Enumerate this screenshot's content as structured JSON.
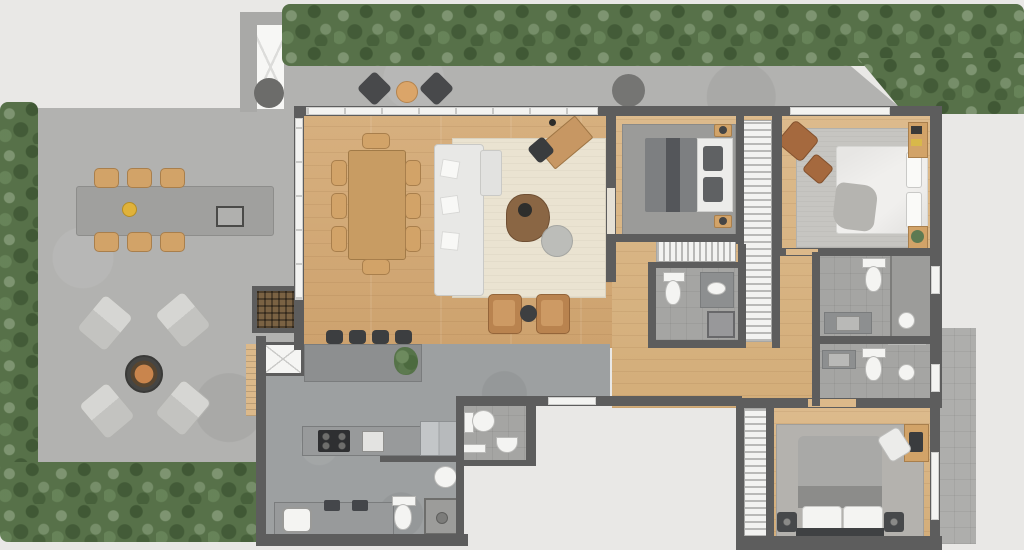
{
  "title": "apartment-floor-plan",
  "view": "top-down-render",
  "palette": {
    "background": "#e9e8e6",
    "walls": "#5d5d5d",
    "wood_floor": "#d3ab79",
    "concrete_floor": "#9da0a1",
    "terrace_concrete": "#b2b2b0",
    "hedge_green": "#577149",
    "rug_cream": "#eae3d1",
    "fixture_white": "#f4f4f2",
    "furniture_wood": "#c89c63",
    "dark_stool": "#3c3e40",
    "leather_brown": "#a5693e",
    "fire_accent": "#c9854d"
  },
  "outdoor": {
    "hedges": [
      "top-band",
      "top-right-block",
      "left-band",
      "bottom-left-band"
    ],
    "walkway": {
      "stools": 2,
      "round_side_table": 1,
      "planter_box_with_tree": 1,
      "round_planter": 1
    },
    "terrace": {
      "outdoor_dining_table": 1,
      "dining_chairs": 6,
      "grill": 1,
      "serving_bowl": 1,
      "fire_pit": 1,
      "lounge_chairs": 4,
      "green_wall_trellis": 1
    },
    "side_patio": 1
  },
  "rooms": [
    {
      "name": "living-dining",
      "floor": "wood",
      "items": [
        "dining-table",
        "dining-chairs-8",
        "l-shaped-sofa",
        "throw-pillows",
        "cream-rug",
        "organic-coffee-table",
        "pouf",
        "armchairs-2",
        "round-side-table",
        "angled-desk",
        "desk-chair",
        "floor-lamp",
        "sliding-glass-walls"
      ]
    },
    {
      "name": "kitchen",
      "floor": "concrete",
      "items": [
        "bar-counter",
        "bar-stools-4",
        "plant",
        "island-counter",
        "cooktop",
        "oven",
        "refrigerator",
        "lower-counter",
        "washer",
        "sinks-2",
        "elevator-shaft",
        "entry-step"
      ]
    },
    {
      "name": "powder-room",
      "floor": "tile",
      "items": [
        "toilet",
        "half-round-basin",
        "shelf"
      ]
    },
    {
      "name": "service-bathroom",
      "floor": "tile",
      "items": [
        "round-basin",
        "toilet",
        "shower"
      ]
    },
    {
      "name": "hallway",
      "floor": "wood",
      "items": [
        "south-window",
        "striped-dresser"
      ]
    },
    {
      "name": "bedroom-1",
      "floor": "wood",
      "items": [
        "double-bed-gray",
        "gray-rug",
        "nightstands-2",
        "wardrobe-strip",
        "window"
      ]
    },
    {
      "name": "bathroom-1",
      "floor": "tile",
      "items": [
        "toilet",
        "vanity-with-sink",
        "shower"
      ]
    },
    {
      "name": "master-bedroom",
      "floor": "wood",
      "items": [
        "double-bed-white",
        "light-rug",
        "leather-armchair",
        "ottoman",
        "wall-shelves",
        "window"
      ]
    },
    {
      "name": "bathroom-2",
      "floor": "tile",
      "items": [
        "toilet",
        "vanity",
        "shower",
        "wall-basin",
        "window"
      ]
    },
    {
      "name": "bathroom-3",
      "floor": "tile",
      "items": [
        "vanity",
        "toilet",
        "shower",
        "wall-basin",
        "window",
        "niche"
      ]
    },
    {
      "name": "bedroom-2",
      "floor": "wood",
      "items": [
        "double-bed-gray",
        "rug",
        "nightstands-2",
        "wardrobe-strip",
        "desk",
        "desk-chair",
        "window"
      ]
    }
  ]
}
